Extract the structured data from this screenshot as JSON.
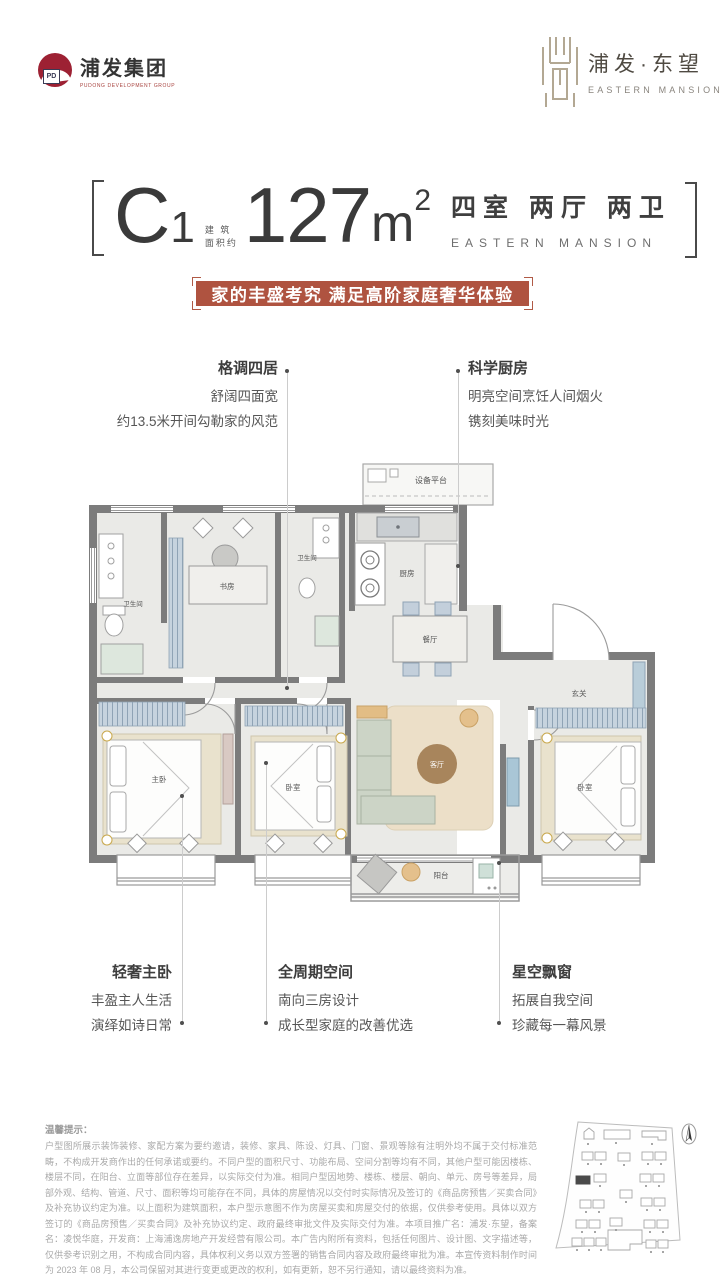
{
  "header": {
    "group_logo": {
      "monogram": "PD",
      "name": "浦发集团",
      "subtitle": "PUDONG DEVELOPMENT GROUP"
    },
    "project_logo": {
      "name": "浦发·东望",
      "subtitle": "EASTERN MANSION"
    }
  },
  "title": {
    "unit": "C",
    "unit_no": "1",
    "area_note": "建 筑\n面积约",
    "area": "127",
    "area_unit": "m",
    "area_sup": "2",
    "layout": "四室 两厅 两卫",
    "layout_en": "EASTERN MANSION"
  },
  "slogan": "家的丰盛考究 满足高阶家庭奢华体验",
  "features": {
    "top_left": {
      "title": "格调四居",
      "line1": "舒阔四面宽",
      "line2": "约13.5米开间勾勒家的风范"
    },
    "top_right": {
      "title": "科学厨房",
      "line1": "明亮空间烹饪人间烟火",
      "line2": "镌刻美味时光"
    },
    "bottom_left": {
      "title": "轻奢主卧",
      "line1": "丰盈主人生活",
      "line2": "演绎如诗日常"
    },
    "bottom_center": {
      "title": "全周期空间",
      "line1": "南向三房设计",
      "line2": "成长型家庭的改善优选"
    },
    "bottom_right": {
      "title": "星空飘窗",
      "line1": "拓展自我空间",
      "line2": "珍藏每一幕风景"
    }
  },
  "plan": {
    "labels": {
      "equipment": "设备平台",
      "kitchen": "厨房",
      "dining": "餐厅",
      "foyer": "玄关",
      "study": "书房",
      "bath1": "卫生间",
      "bath2": "卫生间",
      "master": "主卧",
      "bedroom2": "卧室",
      "living": "客厅",
      "bedroom3": "卧室",
      "balcony": "阳台"
    }
  },
  "disclaimer": {
    "title": "温馨提示：",
    "body": "户型图所展示装饰装修、家配方案为要约邀请，装修、家具、陈设、灯具、门窗、景观等除有注明外均不属于交付标准范畴，不构成开发商作出的任何承诺或要约。不同户型的面积尺寸、功能布局、空间分割等均有不同，其他户型可能因楼栋、楼层不同，在阳台、立面等部位存在差异，以实际交付为准。相同户型因地势、楼栋、楼层、朝向、单元、房号等差异，局部外观、结构、管道、尺寸、面积等均可能存在不同，具体的房屋情况以交付时实际情况及签订的《商品房预售／买卖合同》及补充协议约定为准。以上面积为建筑面积，本户型示意图不作为房屋买卖和房屋交付的依据，仅供参考使用。具体以双方签订的《商品房预售／买卖合同》及补充协议约定、政府最终审批文件及实际交付为准。本项目推广名：浦发·东望，备案名：凌悦华庭，开发商：上海浦逸房地产开发经营有限公司。本广告内附所有资料，包括任何图片、设计图、文字描述等，仅供参考识别之用，不构成合同内容，具体权利义务以双方签署的销售合同内容及政府最终审批为准。本宣传资料制作时间为 2023 年 08 月，本公司保留对其进行变更或更改的权利，如有更新，恕不另行通知，请以最终资料为准。"
  },
  "colors": {
    "accent_red": "#af5340",
    "logo_red": "#9d2133",
    "wall_gray": "#7c7c7c"
  }
}
